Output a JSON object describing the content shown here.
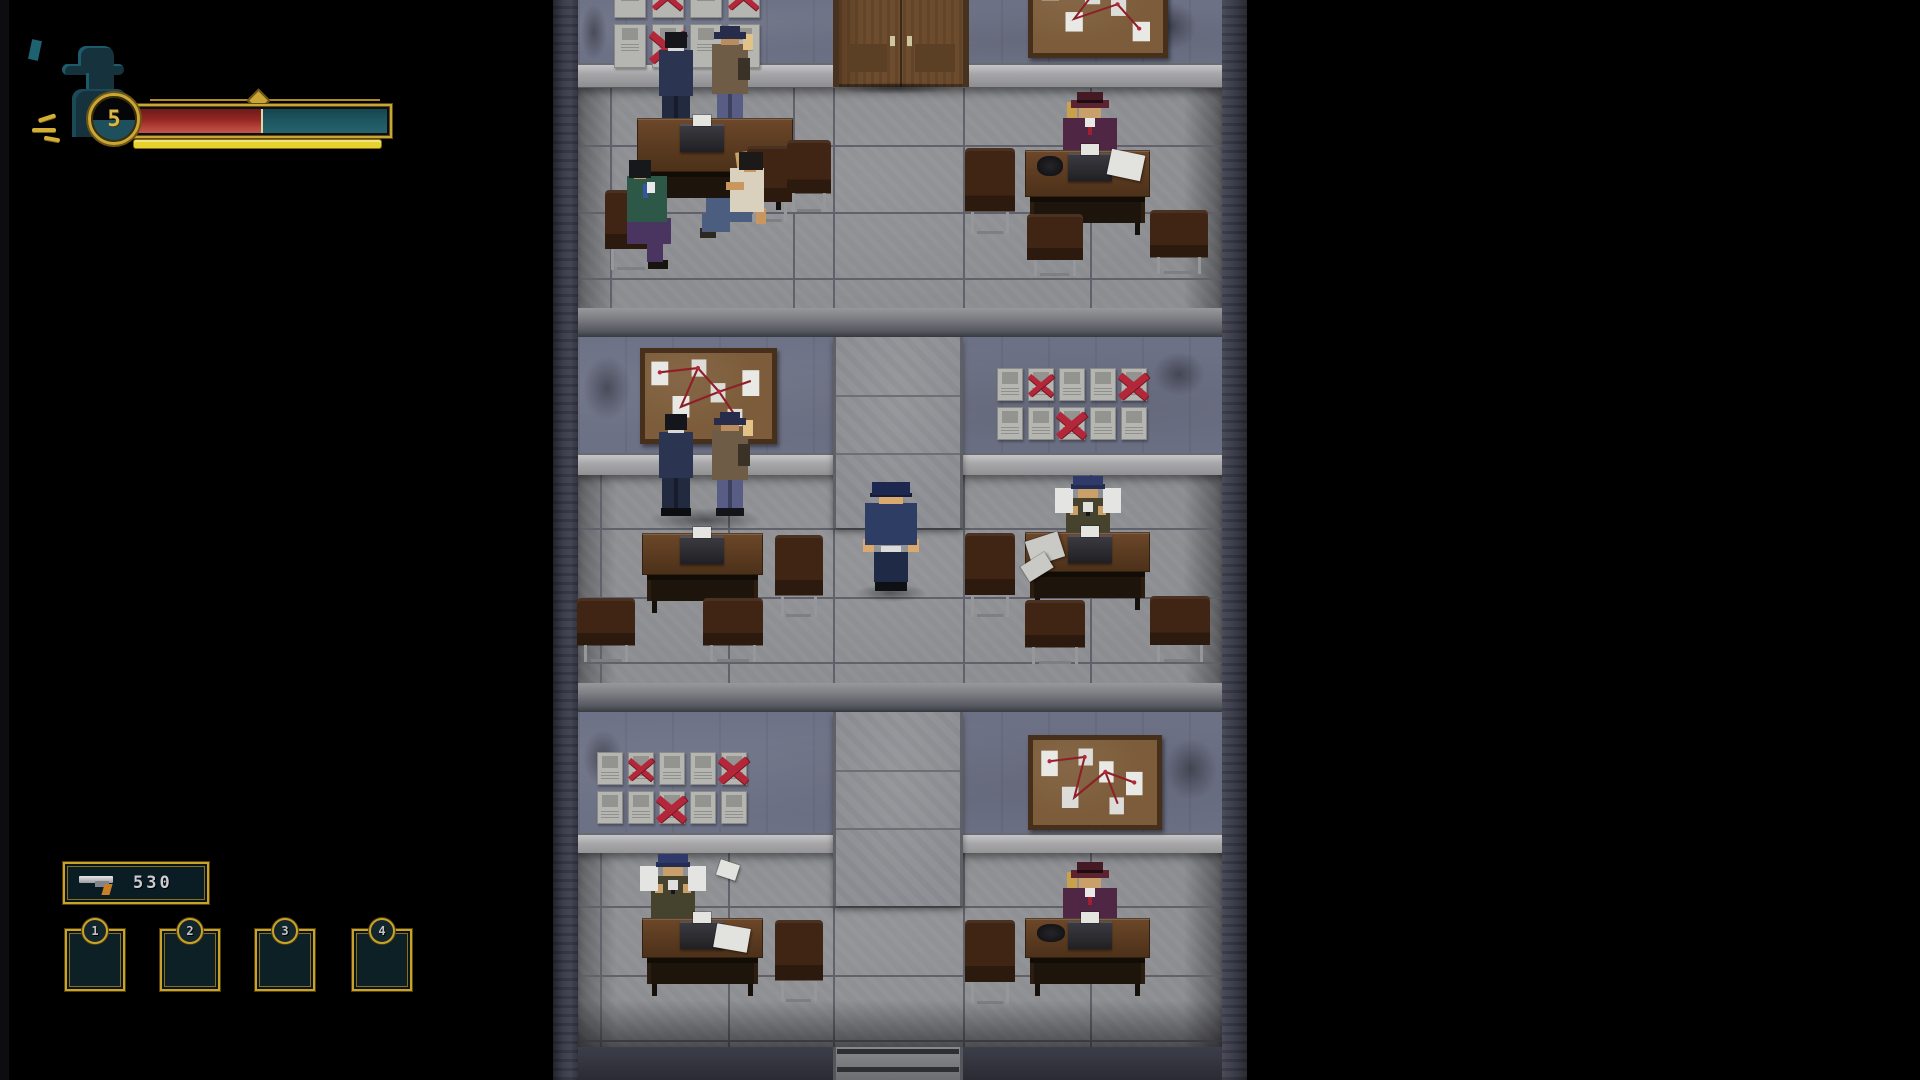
{
  "hud": {
    "portrait": {
      "icon": "detective-portrait-icon"
    },
    "level_badge": {
      "value": "5"
    },
    "health_bar": {
      "fill_percent": 50,
      "fill_style": "width:50%",
      "fill_color": "#942723",
      "empty_color": "#1d5560",
      "frame_color": "#caa637"
    },
    "energy_underline": {
      "fill_percent": 100,
      "color": "#e6d22e"
    }
  },
  "inventory": {
    "ammo_panel": {
      "weapon_icon": "pistol-icon",
      "ammo_count": "530"
    },
    "slots": [
      {
        "hotkey": "1",
        "item": null
      },
      {
        "hotkey": "2",
        "item": null
      },
      {
        "hotkey": "3",
        "item": null
      },
      {
        "hotkey": "4",
        "item": null
      }
    ]
  },
  "scene": {
    "location": "police-detective-office-building-cross-section",
    "floors": [
      {
        "id": 1,
        "left_room": [
          "wanted-poster-wall",
          "two-detectives-talking",
          "desk-with-typewriter",
          "two-seated-men-interview"
        ],
        "center": "wooden-double-door",
        "right_room": [
          "evidence-board",
          "typist-in-purple-suit-at-desk"
        ]
      },
      {
        "id": 2,
        "left_room": [
          "evidence-board",
          "two-detectives-talking",
          "desk-with-typewriter"
        ],
        "center": "player-police-officer-in-corridor",
        "right_room": [
          "wanted-poster-wall",
          "detective-reading-papers-at-desk"
        ]
      },
      {
        "id": 3,
        "left_room": [
          "wanted-poster-wall",
          "detective-sorting-papers-at-desk",
          "flying-paper"
        ],
        "center": "corridor-stairwell",
        "right_room": [
          "evidence-board",
          "typist-in-purple-suit-at-desk"
        ]
      }
    ]
  },
  "colors": {
    "hud_gold": "#caa637",
    "hud_teal": "#1d5560",
    "health_red": "#942723",
    "panel_teal": "#0b1d24",
    "poster_x_red": "#b3273a"
  }
}
